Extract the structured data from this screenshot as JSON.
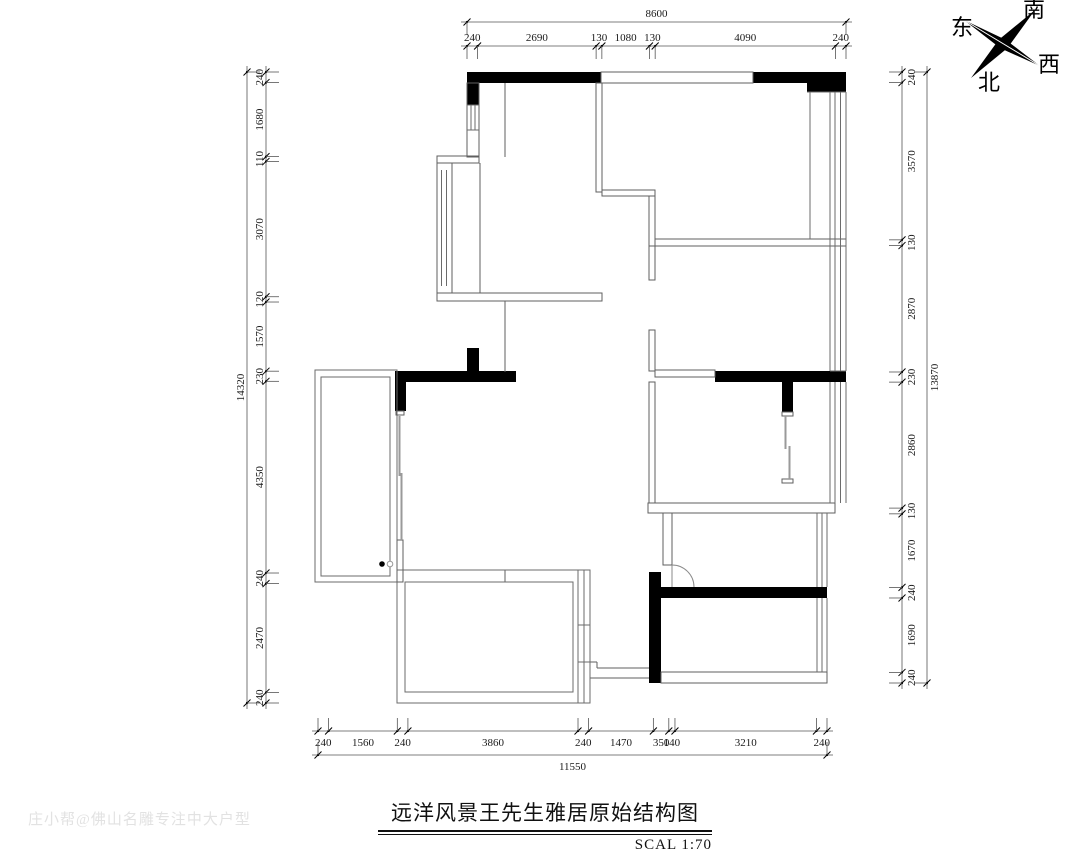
{
  "title": {
    "text": "远洋风景王先生雅居原始结构图",
    "scale_label": "SCAL 1:70"
  },
  "watermark": "庄小帮@佛山名雕专注中大户型",
  "compass": {
    "east": "东",
    "south": "南",
    "west": "西",
    "north": "北"
  },
  "dimensions": {
    "top": {
      "total": "8600",
      "segments": [
        "240",
        "2690",
        "130",
        "1080",
        "130",
        "4090",
        "240"
      ]
    },
    "bottom": {
      "total": "11550",
      "segments": [
        "240",
        "1560",
        "240",
        "3860",
        "240",
        "1470",
        "350",
        "140",
        "3210",
        "240"
      ]
    },
    "left": {
      "total": "14320",
      "segments": [
        "240",
        "1680",
        "110",
        "3070",
        "120",
        "1570",
        "230",
        "4350",
        "240",
        "2470",
        "240"
      ]
    },
    "right": {
      "total": "13870",
      "segments": [
        "240",
        "3570",
        "130",
        "2870",
        "230",
        "2860",
        "130",
        "1670",
        "240",
        "1690",
        "240"
      ]
    }
  },
  "colors": {
    "load_bearing_wall": "#000000",
    "partition_wall": "#5f5f5f",
    "dim_line": "#555555",
    "dim_text": "#1a1a1a",
    "watermark": "#e2e2e2"
  }
}
